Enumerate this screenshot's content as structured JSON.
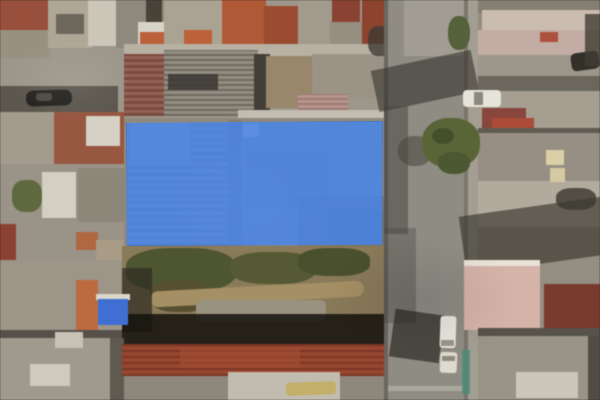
{
  "map": {
    "view_type": "satellite-aerial",
    "description": "Aerial photo of dense urban blocks; a blue semi-transparent polygon highlights a property parcel; vertical street on the right with trees and parked vehicles; vacant dirt lot below the parcel",
    "width": 600,
    "height": 400,
    "base_color": "#8e887c"
  },
  "highlight": {
    "label": "property-boundary",
    "x": 126,
    "y": 121,
    "width": 257,
    "height": 125,
    "fill_color": "#4286f4",
    "fill_opacity": 0.78,
    "border_color": "rgba(25,80,180,0.35)"
  },
  "features": [
    {
      "n": "city-block",
      "x": 0,
      "y": 0,
      "w": 390,
      "h": 120,
      "c": "#9d968a"
    },
    {
      "n": "rooftop-red",
      "x": 0,
      "y": 0,
      "w": 52,
      "h": 32,
      "c": "#9a4f3c"
    },
    {
      "n": "rooftop",
      "x": 0,
      "y": 30,
      "w": 50,
      "h": 28,
      "c": "#98917f"
    },
    {
      "n": "rooftop",
      "x": 48,
      "y": 0,
      "w": 44,
      "h": 48,
      "c": "#aea795"
    },
    {
      "n": "rooftop-dark",
      "x": 56,
      "y": 14,
      "w": 28,
      "h": 20,
      "c": "#6e685c"
    },
    {
      "n": "rooftop-white",
      "x": 88,
      "y": 0,
      "w": 30,
      "h": 46,
      "c": "#ccc6b8"
    },
    {
      "n": "rooftop",
      "x": 116,
      "y": 0,
      "w": 52,
      "h": 48,
      "c": "#8f897c"
    },
    {
      "n": "rooftop-dark",
      "x": 146,
      "y": 0,
      "w": 16,
      "h": 40,
      "c": "#474338"
    },
    {
      "n": "rooftop-white",
      "x": 138,
      "y": 22,
      "w": 26,
      "h": 22,
      "c": "#d8d3c6"
    },
    {
      "n": "rooftop",
      "x": 164,
      "y": 0,
      "w": 62,
      "h": 52,
      "c": "#aaa393"
    },
    {
      "n": "rooftop-red",
      "x": 222,
      "y": 0,
      "w": 44,
      "h": 56,
      "c": "#b25834"
    },
    {
      "n": "rooftop-red",
      "x": 264,
      "y": 6,
      "w": 34,
      "h": 48,
      "c": "#9d4a2e"
    },
    {
      "n": "rooftop",
      "x": 298,
      "y": 0,
      "w": 36,
      "h": 58,
      "c": "#a29b8c"
    },
    {
      "n": "rooftop-red",
      "x": 332,
      "y": 0,
      "w": 28,
      "h": 22,
      "c": "#8c4231"
    },
    {
      "n": "rooftop",
      "x": 330,
      "y": 22,
      "w": 34,
      "h": 40,
      "c": "#968f80"
    },
    {
      "n": "rooftop-red",
      "x": 362,
      "y": 0,
      "w": 28,
      "h": 50,
      "c": "#8f432d"
    },
    {
      "n": "chimney",
      "x": 140,
      "y": 32,
      "w": 24,
      "h": 18,
      "c": "#bf5f3a"
    },
    {
      "n": "chimney",
      "x": 184,
      "y": 30,
      "w": 28,
      "h": 18,
      "c": "#c06038"
    },
    {
      "n": "alley-shadow",
      "x": 0,
      "y": 86,
      "w": 118,
      "h": 26,
      "c": "#5b574e"
    },
    {
      "n": "parked-car-dark",
      "x": 26,
      "y": 90,
      "w": 46,
      "h": 16,
      "c": "#262420",
      "r": "7px",
      "rot": -2
    },
    {
      "n": "car-roof-highlight",
      "x": 36,
      "y": 93,
      "w": 16,
      "h": 8,
      "c": "#4e4a42",
      "r": "3px"
    },
    {
      "n": "rooftop",
      "x": 0,
      "y": 112,
      "w": 56,
      "h": 52,
      "c": "#a39b8c"
    },
    {
      "n": "rooftop-red",
      "x": 54,
      "y": 112,
      "w": 70,
      "h": 52,
      "c": "#99573f"
    },
    {
      "n": "rooftop-white",
      "x": 86,
      "y": 116,
      "w": 34,
      "h": 30,
      "c": "#d6d1c4"
    },
    {
      "n": "rooftop",
      "x": 0,
      "y": 164,
      "w": 124,
      "h": 96,
      "c": "#9a9386"
    },
    {
      "n": "yard-green",
      "x": 12,
      "y": 180,
      "w": 30,
      "h": 32,
      "c": "#5e6a3c",
      "r": "40%"
    },
    {
      "n": "rooftop-white",
      "x": 42,
      "y": 172,
      "w": 34,
      "h": 46,
      "c": "#d4cfc2"
    },
    {
      "n": "rooftop",
      "x": 78,
      "y": 168,
      "w": 46,
      "h": 54,
      "c": "#8d8779"
    },
    {
      "n": "rooftop-red",
      "x": 0,
      "y": 224,
      "w": 16,
      "h": 40,
      "c": "#8c4030"
    },
    {
      "n": "rooftop-terracotta",
      "x": 76,
      "y": 232,
      "w": 22,
      "h": 18,
      "c": "#b2673e"
    },
    {
      "n": "rooftop-tan",
      "x": 96,
      "y": 240,
      "w": 28,
      "h": 20,
      "c": "#a89c85"
    },
    {
      "n": "rooftop-strip",
      "x": 124,
      "y": 44,
      "w": 268,
      "h": 14,
      "c": "#b8b1a2"
    },
    {
      "n": "rooftop-brick",
      "x": 124,
      "y": 54,
      "w": 44,
      "h": 62,
      "c": "#8a574a",
      "stripes": [
        0,
        "#7c4a3e",
        3,
        "#966155",
        6
      ]
    },
    {
      "n": "corrugated-roof",
      "x": 164,
      "y": 50,
      "w": 94,
      "h": 66,
      "c": "#8b857a",
      "stripes": [
        0,
        "#6e6960",
        2,
        "#938d81",
        5
      ]
    },
    {
      "n": "corrugated-dark-patch",
      "x": 168,
      "y": 74,
      "w": 50,
      "h": 16,
      "c": "#3a3733",
      "o": 0.85
    },
    {
      "n": "roof-shadow",
      "x": 254,
      "y": 54,
      "w": 16,
      "h": 62,
      "c": "#433f38"
    },
    {
      "n": "shed-tan",
      "x": 266,
      "y": 56,
      "w": 46,
      "h": 52,
      "c": "#99876a"
    },
    {
      "n": "rooftop",
      "x": 312,
      "y": 54,
      "w": 78,
      "h": 44,
      "c": "#9a9385"
    },
    {
      "n": "pink-corrugated-roof",
      "x": 298,
      "y": 94,
      "w": 50,
      "h": 26,
      "c": "#ad8a80",
      "stripes": [
        0,
        "#9c7a72",
        2,
        "#b9948c",
        5
      ]
    },
    {
      "n": "tree-shadow",
      "x": 368,
      "y": 26,
      "w": 24,
      "h": 30,
      "c": "#3e3b34",
      "r": "40%",
      "o": 0.8
    },
    {
      "n": "rooftop-strip-white",
      "x": 238,
      "y": 110,
      "w": 154,
      "h": 10,
      "c": "#c3bdb0"
    },
    {
      "n": "parcel-rooftops",
      "x": 124,
      "y": 118,
      "w": 268,
      "h": 130,
      "c": "#8f897d"
    },
    {
      "n": "parcel-corrugated",
      "x": 128,
      "y": 122,
      "w": 100,
      "h": 124,
      "c": "#8d8276",
      "stripes": [
        0,
        "#837a6e",
        3,
        "#958c80",
        7
      ]
    },
    {
      "n": "parcel-structure",
      "x": 228,
      "y": 120,
      "w": 14,
      "h": 126,
      "c": "#837d72"
    },
    {
      "n": "parcel-structure",
      "x": 246,
      "y": 146,
      "w": 86,
      "h": 62,
      "c": "#8a8478"
    },
    {
      "n": "parcel-structure",
      "x": 298,
      "y": 196,
      "w": 86,
      "h": 50,
      "c": "#7e796d"
    },
    {
      "n": "parcel-skylight",
      "x": 243,
      "y": 124,
      "w": 16,
      "h": 13,
      "c": "#b4aea1"
    },
    {
      "n": "parcel-structure",
      "x": 330,
      "y": 210,
      "w": 55,
      "h": 36,
      "c": "#787369"
    },
    {
      "n": "parcel-structure",
      "x": 130,
      "y": 124,
      "w": 60,
      "h": 40,
      "c": "#989186"
    },
    {
      "n": "vacant-lot-dirt",
      "x": 122,
      "y": 246,
      "w": 270,
      "h": 100,
      "c": "#8a7a58"
    },
    {
      "n": "scrub-vegetation",
      "x": 126,
      "y": 248,
      "w": 110,
      "h": 44,
      "c": "#4d5530",
      "r": "40%"
    },
    {
      "n": "scrub-vegetation",
      "x": 230,
      "y": 252,
      "w": 86,
      "h": 32,
      "c": "#555a33",
      "r": "40%"
    },
    {
      "n": "scrub-vegetation",
      "x": 298,
      "y": 248,
      "w": 72,
      "h": 28,
      "c": "#4a502d",
      "r": "40%"
    },
    {
      "n": "scrub-vegetation",
      "x": 150,
      "y": 280,
      "w": 60,
      "h": 32,
      "c": "#57502f",
      "r": "40%"
    },
    {
      "n": "dirt-path",
      "x": 150,
      "y": 286,
      "w": 214,
      "h": 16,
      "c": "#a68f62",
      "rot": -3,
      "r": "8px"
    },
    {
      "n": "rubble",
      "x": 196,
      "y": 300,
      "w": 130,
      "h": 22,
      "c": "#99927e",
      "r": "6px"
    },
    {
      "n": "lot-dark-edge",
      "x": 122,
      "y": 268,
      "w": 30,
      "h": 64,
      "c": "#2e2b20",
      "o": 0.7
    },
    {
      "n": "lot-shadow",
      "x": 122,
      "y": 314,
      "w": 270,
      "h": 34,
      "c": "#14120d",
      "o": 0.85
    },
    {
      "n": "rooftop",
      "x": 0,
      "y": 260,
      "w": 122,
      "h": 78,
      "c": "#9c9587"
    },
    {
      "n": "building-orange",
      "x": 76,
      "y": 280,
      "w": 22,
      "h": 50,
      "c": "#bf6a3e"
    },
    {
      "n": "tarp-white-edge",
      "x": 96,
      "y": 294,
      "w": 34,
      "h": 6,
      "c": "#dcd7cb"
    },
    {
      "n": "blue-tarp-roof",
      "x": 98,
      "y": 299,
      "w": 30,
      "h": 26,
      "c": "#3e6fd8"
    },
    {
      "n": "roof-seam",
      "x": 0,
      "y": 330,
      "w": 122,
      "h": 10,
      "c": "#55514a"
    },
    {
      "n": "rooftop",
      "x": 0,
      "y": 338,
      "w": 122,
      "h": 62,
      "c": "#a09a8d"
    },
    {
      "n": "rooftop-white",
      "x": 30,
      "y": 364,
      "w": 40,
      "h": 22,
      "c": "#cfcabd"
    },
    {
      "n": "rooftop-white",
      "x": 55,
      "y": 332,
      "w": 28,
      "h": 16,
      "c": "#c8c2b5"
    },
    {
      "n": "dark-gap",
      "x": 110,
      "y": 338,
      "w": 14,
      "h": 62,
      "c": "#5e5a50"
    },
    {
      "n": "red-tile-roof",
      "x": 122,
      "y": 344,
      "w": 268,
      "h": 32,
      "c": "#93402c",
      "stripes": [
        0,
        "#7e3524",
        2,
        "#9c452f",
        6
      ]
    },
    {
      "n": "red-tile-light",
      "x": 180,
      "y": 348,
      "w": 120,
      "h": 20,
      "c": "#a54c31",
      "o": 0.6
    },
    {
      "n": "rooftop-cream",
      "x": 228,
      "y": 372,
      "w": 112,
      "h": 28,
      "c": "#c2bcaf"
    },
    {
      "n": "truck-yellow",
      "x": 286,
      "y": 382,
      "w": 50,
      "h": 13,
      "c": "#c3b065",
      "r": "3px",
      "rot": -2
    },
    {
      "n": "street",
      "x": 384,
      "y": 0,
      "w": 86,
      "h": 400,
      "c": "#8f8c84"
    },
    {
      "n": "street-edge-left",
      "x": 384,
      "y": 0,
      "w": 4,
      "h": 400,
      "c": "#6b675f"
    },
    {
      "n": "street-edge-right",
      "x": 464,
      "y": 0,
      "w": 4,
      "h": 400,
      "c": "#7b766c"
    },
    {
      "n": "sidewalk",
      "x": 468,
      "y": 0,
      "w": 10,
      "h": 400,
      "c": "#a39e92"
    },
    {
      "n": "street-light-patch",
      "x": 404,
      "y": 0,
      "w": 60,
      "h": 56,
      "c": "#b0aca0",
      "o": 0.55
    },
    {
      "n": "street-shadow",
      "x": 374,
      "y": 60,
      "w": 102,
      "h": 42,
      "c": "#35322c",
      "o": 0.6,
      "rot": -12
    },
    {
      "n": "street-shadow",
      "x": 384,
      "y": 106,
      "w": 24,
      "h": 128,
      "c": "#45423b",
      "o": 0.5
    },
    {
      "n": "street-shadow",
      "x": 384,
      "y": 228,
      "w": 32,
      "h": 95,
      "c": "#45423b",
      "o": 0.35
    },
    {
      "n": "street-shadow",
      "x": 392,
      "y": 312,
      "w": 50,
      "h": 48,
      "c": "#26241f",
      "o": 0.65,
      "rot": 8
    },
    {
      "n": "road-marking",
      "x": 388,
      "y": 386,
      "w": 76,
      "h": 5,
      "c": "#c6c1b4",
      "o": 0.5
    },
    {
      "n": "city-block",
      "x": 478,
      "y": 0,
      "w": 122,
      "h": 400,
      "c": "#948d80"
    },
    {
      "n": "row-roof-dark",
      "x": 478,
      "y": 0,
      "w": 122,
      "h": 13,
      "c": "#857e72"
    },
    {
      "n": "row-roof-pink",
      "x": 482,
      "y": 10,
      "w": 118,
      "h": 22,
      "c": "#cbbcae"
    },
    {
      "n": "row-roof",
      "x": 478,
      "y": 30,
      "w": 122,
      "h": 26,
      "c": "#c4aca2"
    },
    {
      "n": "red-spot",
      "x": 540,
      "y": 32,
      "w": 18,
      "h": 10,
      "c": "#b0503c"
    },
    {
      "n": "row-roof",
      "x": 478,
      "y": 55,
      "w": 122,
      "h": 22,
      "c": "#9c958a"
    },
    {
      "n": "parked-car-dark",
      "x": 571,
      "y": 52,
      "w": 28,
      "h": 18,
      "c": "#33302a",
      "r": "5px",
      "rot": -8
    },
    {
      "n": "row-roof-dark",
      "x": 478,
      "y": 76,
      "w": 122,
      "h": 15,
      "c": "#6b675d"
    },
    {
      "n": "row-roof",
      "x": 478,
      "y": 91,
      "w": 122,
      "h": 38,
      "c": "#a59e90"
    },
    {
      "n": "parked-car-white",
      "x": 463,
      "y": 90,
      "w": 38,
      "h": 17,
      "c": "#e6e3d9",
      "r": "4px"
    },
    {
      "n": "car-windshield",
      "x": 474,
      "y": 92,
      "w": 9,
      "h": 13,
      "c": "#8b887e"
    },
    {
      "n": "red-roof-patch",
      "x": 482,
      "y": 108,
      "w": 44,
      "h": 22,
      "c": "#8a453c"
    },
    {
      "n": "red-roof-fragment",
      "x": 492,
      "y": 118,
      "w": 42,
      "h": 12,
      "c": "#ae4a36"
    },
    {
      "n": "row-seam",
      "x": 478,
      "y": 128,
      "w": 122,
      "h": 5,
      "c": "#5f5b52"
    },
    {
      "n": "row-roof",
      "x": 478,
      "y": 133,
      "w": 122,
      "h": 48,
      "c": "#978f82"
    },
    {
      "n": "row-roof-light",
      "x": 478,
      "y": 181,
      "w": 122,
      "h": 46,
      "c": "#b2ab9c"
    },
    {
      "n": "skylight-cream",
      "x": 546,
      "y": 150,
      "w": 18,
      "h": 15,
      "c": "#dbcfa6"
    },
    {
      "n": "skylight-cream",
      "x": 550,
      "y": 168,
      "w": 15,
      "h": 14,
      "c": "#d6caa0"
    },
    {
      "n": "dark-object",
      "x": 556,
      "y": 188,
      "w": 40,
      "h": 22,
      "c": "#3a372f",
      "r": "40%",
      "o": 0.8
    },
    {
      "n": "building-shadow",
      "x": 462,
      "y": 206,
      "w": 150,
      "h": 58,
      "c": "#3c3931",
      "o": 0.68,
      "rot": -8
    },
    {
      "n": "building-pink-top",
      "x": 464,
      "y": 260,
      "w": 76,
      "h": 8,
      "c": "#e8e2d6"
    },
    {
      "n": "building-pink",
      "x": 464,
      "y": 266,
      "w": 76,
      "h": 64,
      "c": "#d7b3a8"
    },
    {
      "n": "roof-darkred",
      "x": 544,
      "y": 284,
      "w": 56,
      "h": 56,
      "c": "#7c3a2e"
    },
    {
      "n": "row-seam",
      "x": 478,
      "y": 328,
      "w": 122,
      "h": 8,
      "c": "#57534a"
    },
    {
      "n": "row-roof",
      "x": 478,
      "y": 336,
      "w": 122,
      "h": 64,
      "c": "#9a9386"
    },
    {
      "n": "rooftop-white",
      "x": 516,
      "y": 372,
      "w": 62,
      "h": 26,
      "c": "#ccc6b9"
    },
    {
      "n": "dark-gap",
      "x": 588,
      "y": 336,
      "w": 12,
      "h": 64,
      "c": "#514d44"
    },
    {
      "n": "dark-object",
      "x": 585,
      "y": 14,
      "w": 15,
      "h": 52,
      "c": "#413d35",
      "o": 0.8
    },
    {
      "n": "tree",
      "x": 448,
      "y": 16,
      "w": 22,
      "h": 34,
      "c": "#55613a",
      "r": "45%"
    },
    {
      "n": "tree-shadow",
      "x": 398,
      "y": 136,
      "w": 34,
      "h": 30,
      "c": "#47443c",
      "r": "45%",
      "o": 0.55
    },
    {
      "n": "tree",
      "x": 422,
      "y": 118,
      "w": 58,
      "h": 50,
      "c": "#5a6535",
      "r": "45%"
    },
    {
      "n": "tree",
      "x": 438,
      "y": 152,
      "w": 32,
      "h": 22,
      "c": "#4c5830",
      "r": "45%"
    },
    {
      "n": "tree-dark",
      "x": 432,
      "y": 128,
      "w": 22,
      "h": 16,
      "c": "#3d4a26",
      "r": "50%",
      "o": 0.8
    },
    {
      "n": "van-white",
      "x": 440,
      "y": 316,
      "w": 16,
      "h": 32,
      "c": "#e9e6dd",
      "r": "3px",
      "rot": 2
    },
    {
      "n": "van-windshield",
      "x": 441,
      "y": 340,
      "w": 13,
      "h": 6,
      "c": "#9a968c"
    },
    {
      "n": "car-white",
      "x": 440,
      "y": 352,
      "w": 17,
      "h": 21,
      "c": "#dedad0",
      "r": "3px",
      "rot": 2
    },
    {
      "n": "car-windshield",
      "x": 442,
      "y": 356,
      "w": 13,
      "h": 5,
      "c": "#8f8b81"
    },
    {
      "n": "teal-fence",
      "x": 462,
      "y": 350,
      "w": 8,
      "h": 44,
      "c": "#4e8a78",
      "o": 0.85
    }
  ]
}
